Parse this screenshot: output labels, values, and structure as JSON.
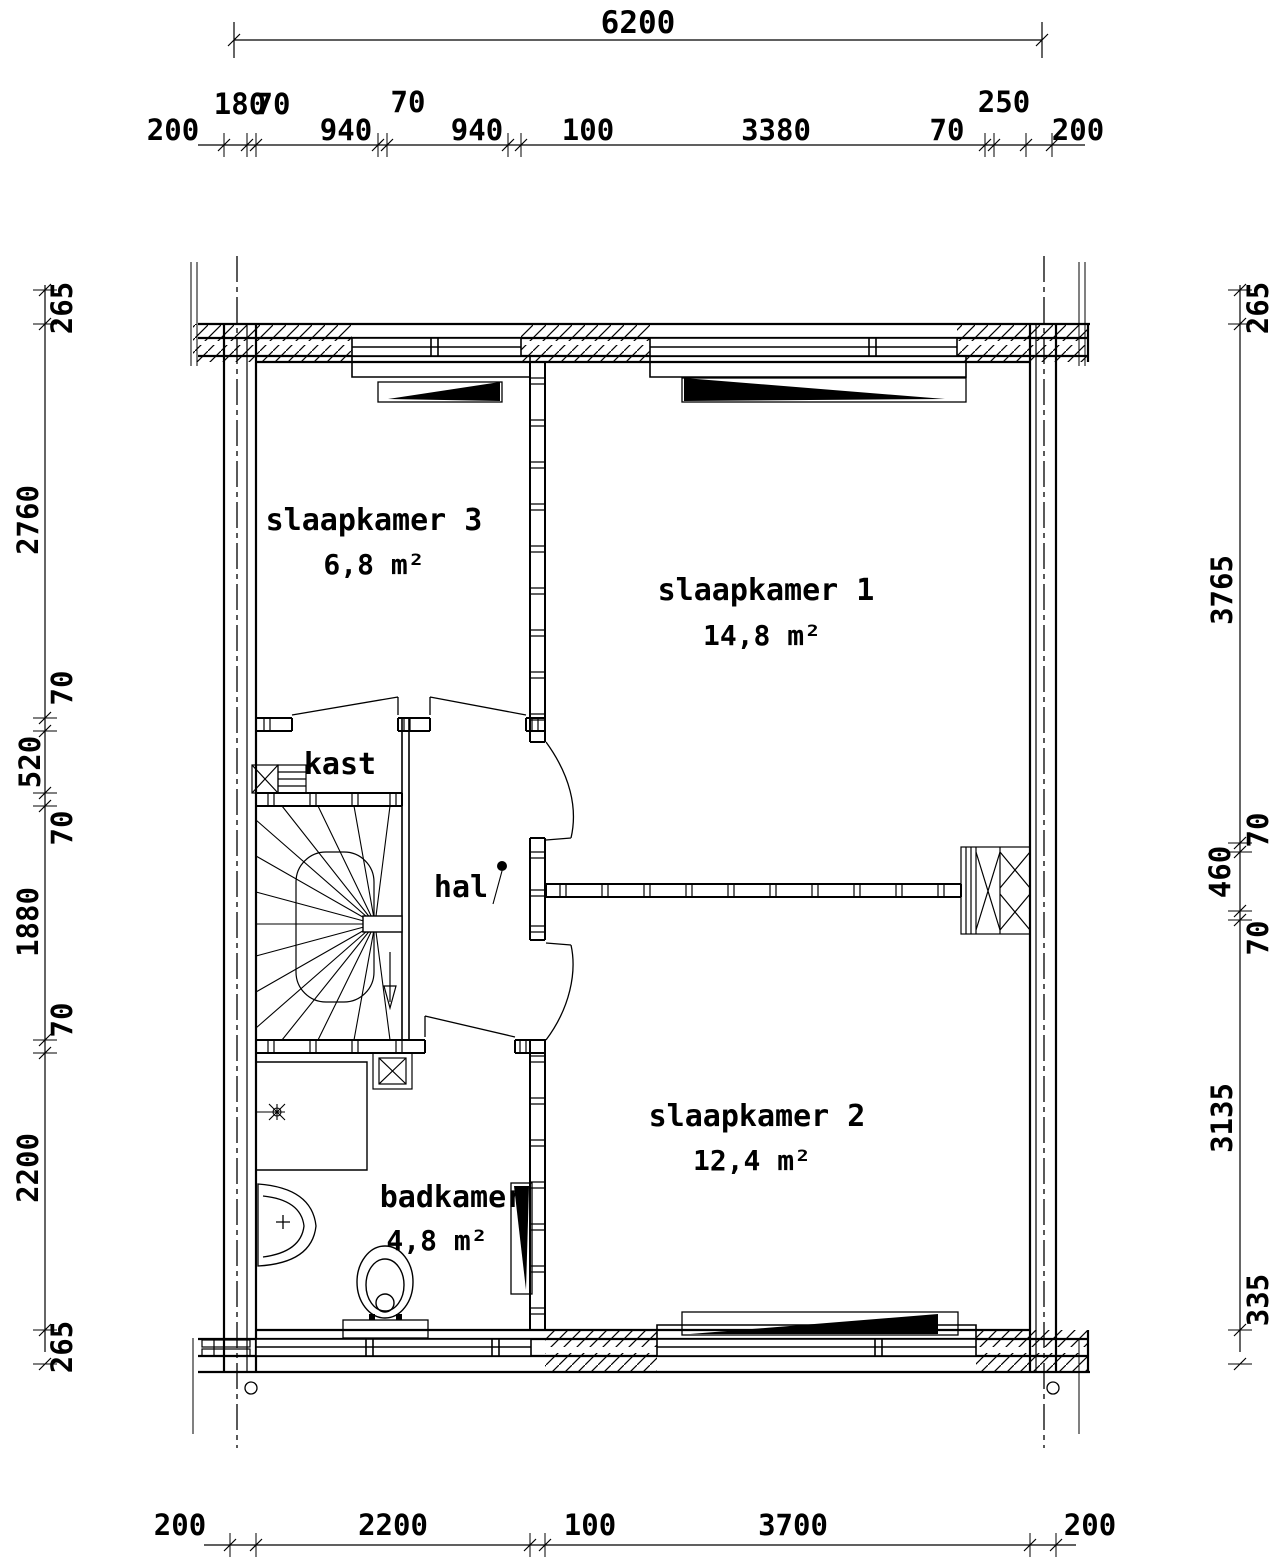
{
  "plan": {
    "rooms": {
      "bedroom3": {
        "name": "slaapkamer 3",
        "area": "6,8 m²"
      },
      "bedroom1": {
        "name": "slaapkamer 1",
        "area": "14,8 m²"
      },
      "bedroom2": {
        "name": "slaapkamer 2",
        "area": "12,4 m²"
      },
      "bathroom": {
        "name": "badkamer",
        "area": "4,8 m²"
      },
      "closet": {
        "name": "kast"
      },
      "hall": {
        "name": "hal"
      }
    },
    "dimensions_mm": {
      "overall_width_top": "6200",
      "top_row": [
        "200",
        "180",
        "70",
        "940",
        "70",
        "940",
        "100",
        "3380",
        "70",
        "250",
        "200"
      ],
      "bottom_row": [
        "200",
        "2200",
        "100",
        "3700",
        "200"
      ],
      "left_column": [
        "265",
        "2760",
        "70",
        "520",
        "70",
        "1880",
        "70",
        "2200",
        "265"
      ],
      "right_column": [
        "265",
        "3765",
        "70",
        "460",
        "70",
        "3135",
        "335"
      ]
    },
    "colors": {
      "line": "#000000",
      "background": "#ffffff"
    }
  }
}
